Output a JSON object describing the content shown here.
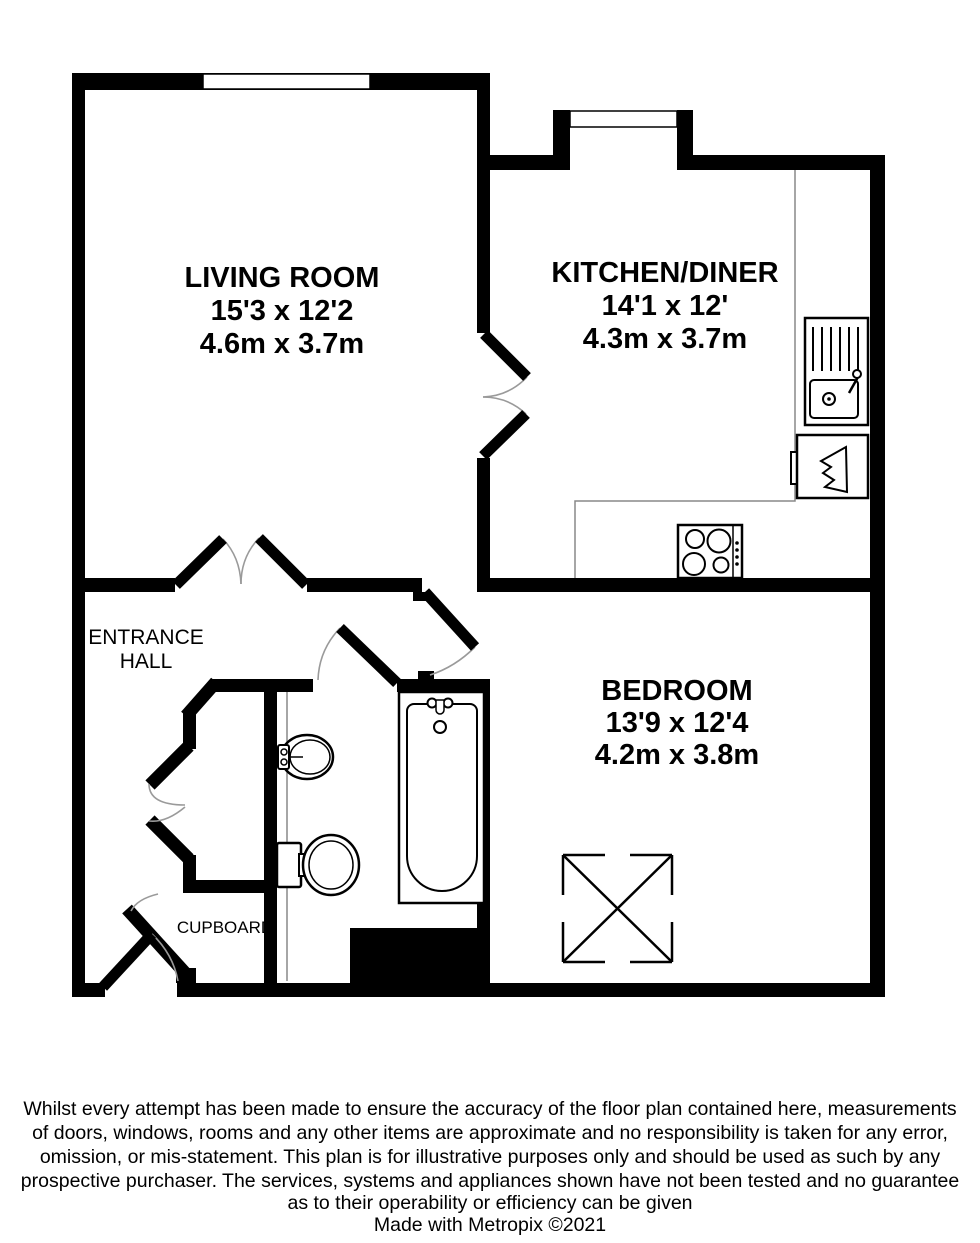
{
  "floorplan": {
    "rooms": {
      "living": {
        "name": "LIVING ROOM",
        "imperial": "15'3 x 12'2",
        "metric": "4.6m x 3.7m"
      },
      "kitchen": {
        "name": "KITCHEN/DINER",
        "imperial": "14'1 x 12'",
        "metric": "4.3m x 3.7m"
      },
      "bedroom": {
        "name": "BEDROOM",
        "imperial": "13'9 x 12'4",
        "metric": "4.2m x 3.8m"
      },
      "hall": {
        "line1": "ENTRANCE",
        "line2": "HALL"
      },
      "cupboard": {
        "label": "CUPBOARD"
      }
    },
    "fixtures": [
      "window",
      "double-swing-doors",
      "kitchen-sink-drainer",
      "kitchen-appliance",
      "hob",
      "bath",
      "wash-basin",
      "toilet",
      "wardrobe"
    ],
    "colors": {
      "wall": "#000000",
      "background": "#ffffff",
      "door_arc": "#9a9a9a",
      "counter_line": "#888888"
    }
  },
  "disclaimer": {
    "lines": [
      "Whilst every attempt has been made to ensure the accuracy of the floor plan contained here, measurements",
      "of doors, windows, rooms and any other items are approximate and no responsibility is taken for any error,",
      "omission, or mis-statement. This plan is for illustrative purposes only and should be used as such by any",
      "prospective purchaser. The services, systems and appliances shown have not been tested and no guarantee",
      "as to their operability or efficiency can be given"
    ]
  },
  "credit": "Made with Metropix ©2021"
}
